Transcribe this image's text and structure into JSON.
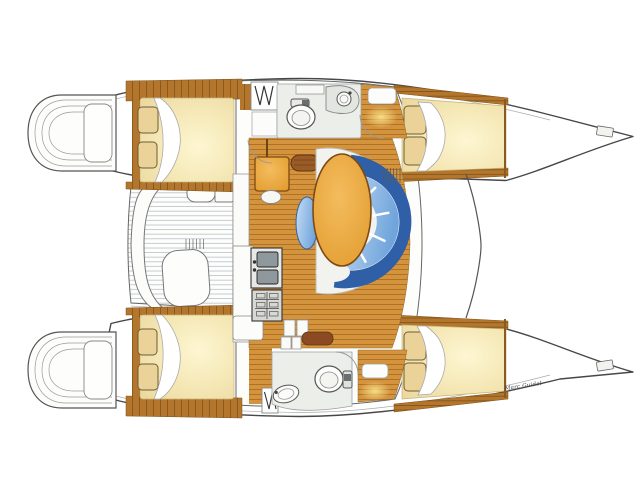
{
  "artwork": {
    "type": "catamaran-interior-deck-plan",
    "signature": "Marc Guidel"
  },
  "colors": {
    "wood": "#D4943E",
    "woodLine": "#A96B22",
    "woodDark": "#B3762C",
    "woodDarkLine": "#7E521A",
    "bedLight": "#FDF6D2",
    "bedMid": "#F5E8B6",
    "bedDeep": "#ECD9A0",
    "pillow": "#EBD298",
    "pillowEdge": "#6E5C35",
    "outline": "#474747",
    "sofaRim": "#2F5FA7",
    "cushionLight": "#C6DDF3",
    "cushionDeep": "#6FA4DC",
    "tableLight": "#F4BC5E",
    "tableDeep": "#E29D30",
    "tableEdge": "#7E4A12",
    "headFloor": "#ECEEE9",
    "glow": "#F9E189",
    "benchBrown": "#9A5B26",
    "cabinetBrown": "#8B4A22",
    "shell": "#F2F3EF",
    "slat": "#B9C0C6"
  }
}
